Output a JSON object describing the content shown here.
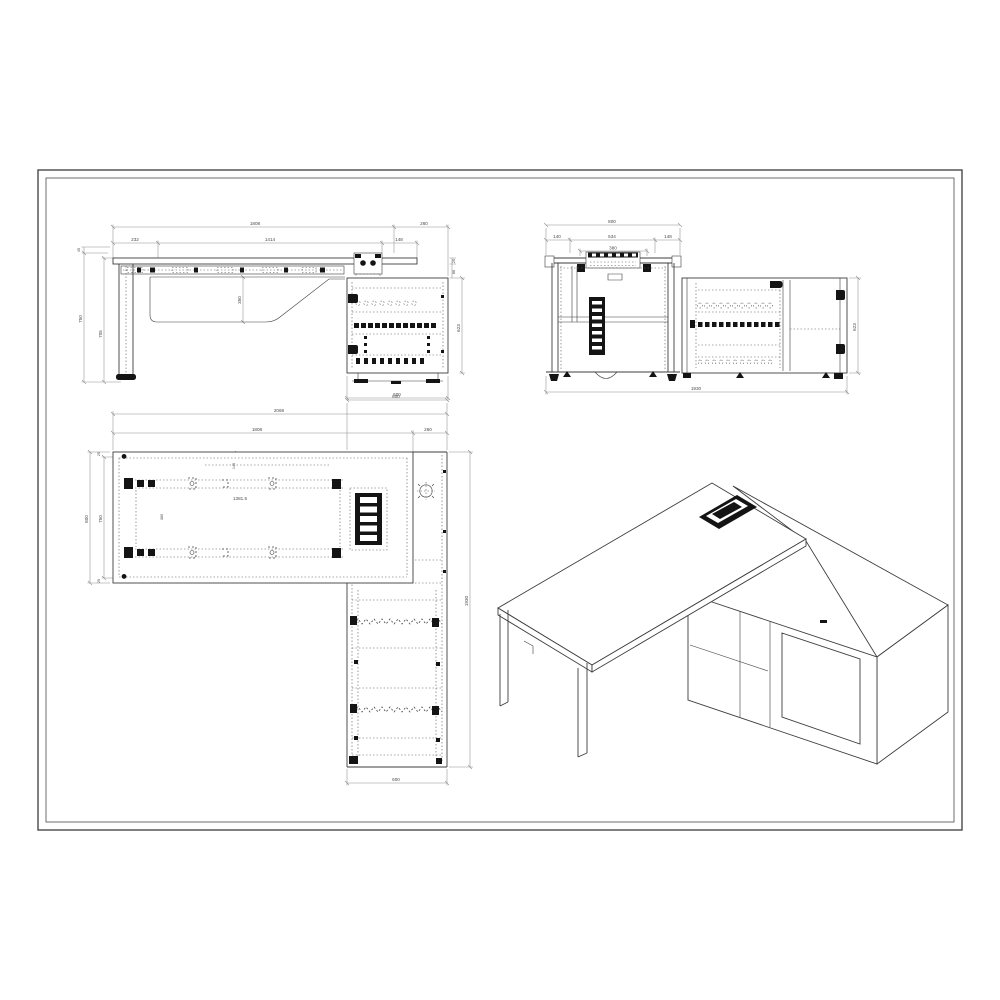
{
  "sheet": {
    "background": "#ffffff",
    "line_color": "#3d3d3d",
    "dim_color": "#909090",
    "accent_black": "#141414"
  },
  "front": {
    "dims": {
      "total": "1808",
      "ext": "260",
      "a": "232",
      "b": "1414",
      "c": "148",
      "h_outer": "750",
      "h_inner": "705",
      "t_top": "45",
      "panel": "350",
      "g1": "25",
      "g2": "86",
      "cab_h": "623",
      "cab_w": "600"
    }
  },
  "side": {
    "dims": {
      "depth": "800",
      "a": "140",
      "b": "534",
      "c": "148",
      "box": "380",
      "cab_h": "623",
      "total": "1930"
    }
  },
  "plan": {
    "dims": {
      "cab_d_top": "600",
      "total": "2068",
      "desk": "1808",
      "ext": "260",
      "d_outer": "800",
      "d_inner": "750",
      "t1": "25",
      "t2": "25",
      "inset": "145",
      "span": "1381.5",
      "gap": "360",
      "length": "1930",
      "cab_d_bot": "600"
    }
  }
}
